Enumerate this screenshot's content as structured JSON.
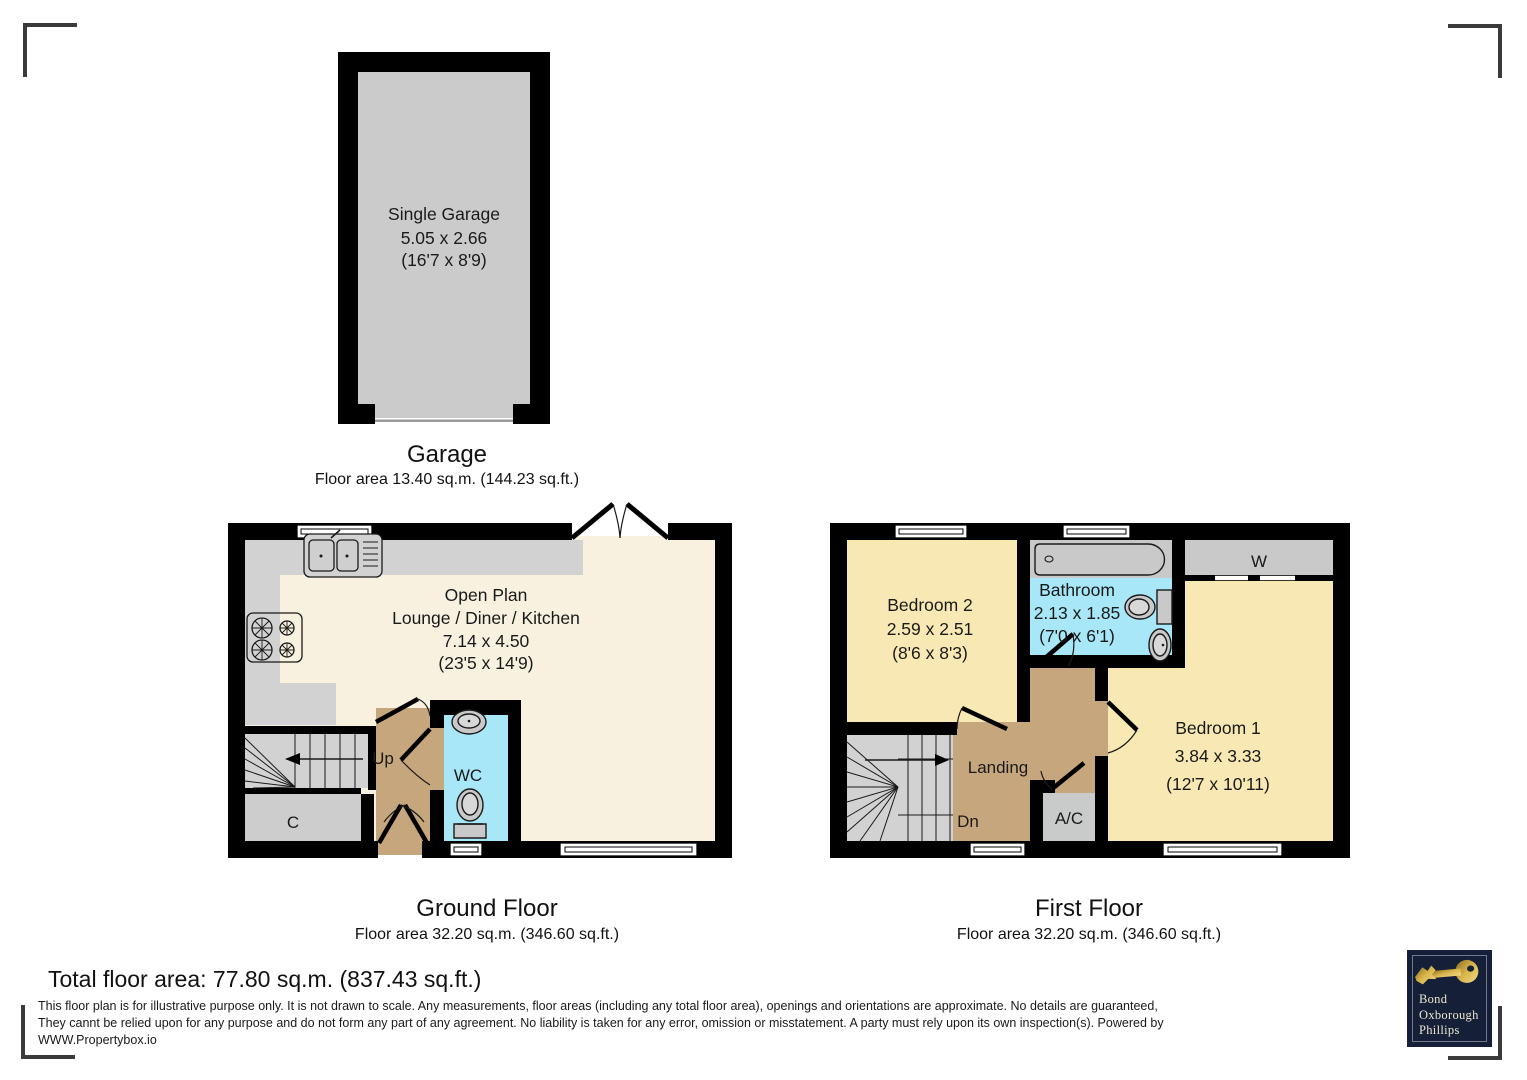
{
  "colors": {
    "wall": "#000000",
    "room_cream": "#f8f1df",
    "room_yellow": "#f8e9b4",
    "room_cyan": "#a8e7f7",
    "floor_tan": "#c6a67c",
    "counter_gray": "#d2d2d2",
    "closet_gray": "#cdcdcd",
    "garage_gray": "#cbcbcb",
    "logo_navy": "#152038",
    "logo_gold": "#d4b04a",
    "logo_text": "#ece4cd",
    "regmark": "#3a3a3a"
  },
  "garage": {
    "room_name": "Single Garage",
    "dim_metric": "5.05 x 2.66",
    "dim_imperial": "(16'7 x 8'9)",
    "title": "Garage",
    "area": "Floor area 13.40 sq.m. (144.23 sq.ft.)"
  },
  "ground_floor": {
    "title": "Ground Floor",
    "area": "Floor area 32.20 sq.m. (346.60 sq.ft.)",
    "open_plan": {
      "name1": "Open Plan",
      "name2": "Lounge / Diner / Kitchen",
      "dim_metric": "7.14 x 4.50",
      "dim_imperial": "(23'5 x 14'9)"
    },
    "stairs_label": "Up",
    "wc_label": "WC",
    "closet_label": "C"
  },
  "first_floor": {
    "title": "First Floor",
    "area": "Floor area 32.20 sq.m. (346.60 sq.ft.)",
    "bedroom2": {
      "name": "Bedroom 2",
      "dim_metric": "2.59 x 2.51",
      "dim_imperial": "(8'6 x 8'3)"
    },
    "bathroom": {
      "name": "Bathroom",
      "dim_metric": "2.13 x 1.85",
      "dim_imperial": "(7'0 x 6'1)"
    },
    "bedroom1": {
      "name": "Bedroom 1",
      "dim_metric": "3.84 x 3.33",
      "dim_imperial": "(12'7 x 10'11)"
    },
    "landing_label": "Landing",
    "stairs_label": "Dn",
    "ac_label": "A/C",
    "wardrobe_label": "W"
  },
  "footer": {
    "total_area": "Total floor area: 77.80 sq.m. (837.43 sq.ft.)",
    "disclaimer1": "This floor plan is for illustrative purpose only. It is not drawn to scale. Any measurements, floor areas (including any total floor area), openings and orientations are approximate. No details are guaranteed,",
    "disclaimer2": "They cannt be relied upon for any purpose and do not form any part of any agreement. No liability is taken for any error, omission or misstatement. A party must rely upon its own inspection(s). Powered by",
    "disclaimer3": "WWW.Propertybox.io"
  },
  "logo": {
    "line1": "Bond",
    "line2": "Oxborough",
    "line3": "Phillips"
  }
}
